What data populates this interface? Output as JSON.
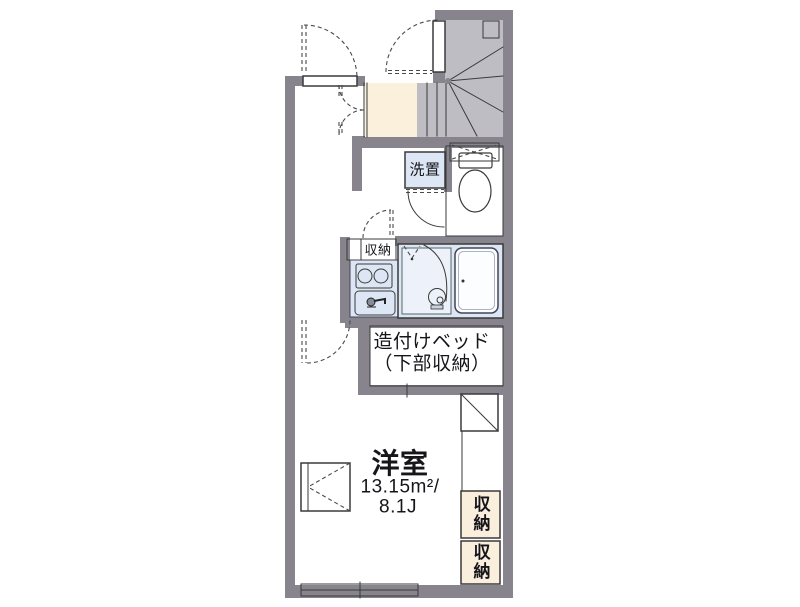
{
  "floor_plan": {
    "labels": {
      "washer": "洗置",
      "kitchen_storage": "収納",
      "bed_line1": "造付けベッド",
      "bed_line2": "（下部収納）",
      "room_name": "洋室",
      "room_area": "13.15m²/",
      "room_size": "8.1J",
      "closet_upper": "収納",
      "closet_lower": "収納"
    },
    "colors": {
      "wall": "#87848e",
      "stair": "#bdbdc3",
      "stair_box": "#b1b0b9",
      "wet_area": "#dce6f4",
      "storage": "#faeedd",
      "entrance": "#faf0dc"
    }
  }
}
